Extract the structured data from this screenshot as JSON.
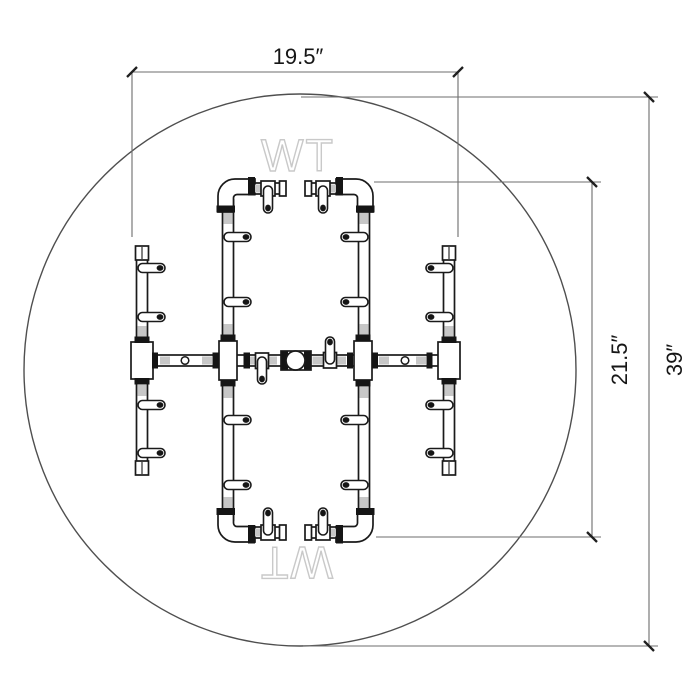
{
  "drawing": {
    "watermark": {
      "text": "WT"
    },
    "dimensions": {
      "burner_width": {
        "label": "19.5″"
      },
      "burner_height": {
        "label": "21.5″"
      },
      "pit_diameter": {
        "label": "39″"
      }
    },
    "colors": {
      "background": "#ffffff",
      "line_art": "#1a1a1a",
      "dimension_lines": "#6d6d6d",
      "dimension_text": "#161616",
      "watermark": "#c9c9c9",
      "fitting_shading": "#c7c7c7"
    }
  }
}
